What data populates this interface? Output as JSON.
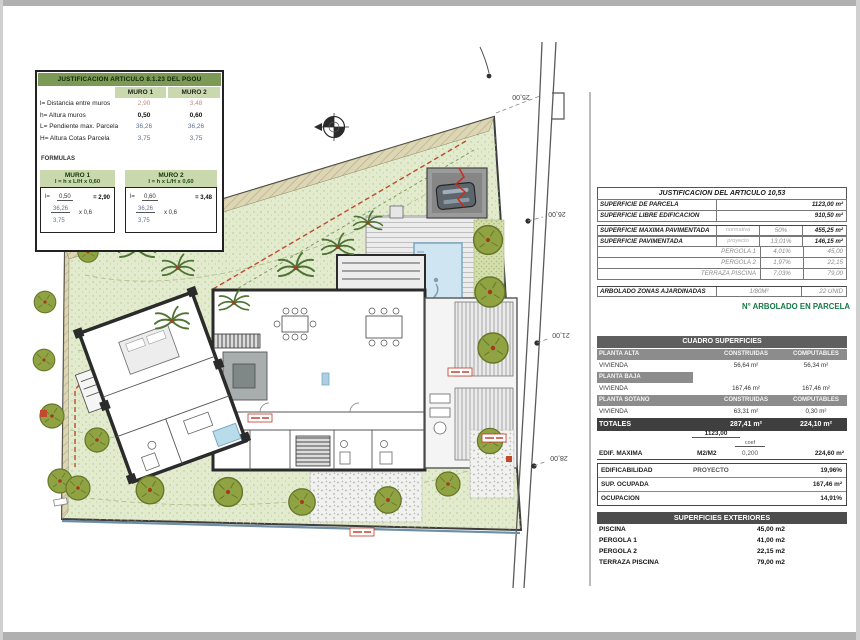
{
  "muros": {
    "title": "JUSTIFICACION ARTICULO 8.1.23 DEL PGOU",
    "col1": "MURO 1",
    "col2": "MURO 2",
    "rows": [
      {
        "label": "l= Distancia entre muros",
        "v1": "2,90",
        "v2": "3,48"
      },
      {
        "label": "h= Altura muros",
        "v1": "0,50",
        "v2": "0,60"
      },
      {
        "label": "L= Pendiente max. Parcela",
        "v1": "36,26",
        "v2": "36,26"
      },
      {
        "label": "H= Altura Cotas Parcela",
        "v1": "3,75",
        "v2": "3,75"
      }
    ],
    "formulas_label": "FORMULAS",
    "boxes": [
      {
        "name": "MURO 1",
        "rule": "l = h x L/H x 0,60",
        "lhs": "l=",
        "num": "0,50",
        "den_top": "36,26",
        "den_bot": "3,75",
        "mult": "x 0,6",
        "result": "= 2,90"
      },
      {
        "name": "MURO 2",
        "rule": "l = h x L/H x 0,60",
        "lhs": "l=",
        "num": "0,60",
        "den_top": "36,26",
        "den_bot": "3,75",
        "mult": "x 0,6",
        "result": "= 3,48"
      }
    ]
  },
  "plan": {
    "dims": [
      "25,00",
      "26,00",
      "21,00",
      "28,00"
    ]
  },
  "justif": {
    "title": "JUSTIFICACION DEL ARTICULO 10,53",
    "rows": [
      {
        "label": "SUPERFICIE DE PARCELA",
        "val": "1123,00 m²"
      },
      {
        "label": "SUPERFICIE LIBRE EDIFICACION",
        "val": "910,50 m²"
      },
      {
        "label": "SUPERFICIE MAXIMA PAVIMENTADA",
        "mid": "normativa",
        "pct": "50%",
        "val": "455,25 m²"
      },
      {
        "label": "SUPERFICIE PAVIMENTADA",
        "mid": "proyecto",
        "pct": "13,01%",
        "val": "146,15 m²"
      },
      {
        "label": "PERGOLA 1",
        "pct": "4,01%",
        "val": "45,00"
      },
      {
        "label": "PERGOLA 2",
        "pct": "1,97%",
        "val": "22,15"
      },
      {
        "label": "TERRAZA PISCINA",
        "pct": "7,03%",
        "val": "79,00"
      },
      {
        "label": "ARBOLADO ZONAS AJARDINADAS",
        "pct": "1/80M²",
        "val": "22 UNID"
      }
    ]
  },
  "arbolado_note": "N° ARBOLADO EN PARCELA",
  "cuadro": {
    "title": "CUADRO SUPERFICIES",
    "col_construidas": "CONSTRUIDAS",
    "col_computables": "COMPUTABLES",
    "banda_alta": "PLANTA ALTA",
    "banda_baja": "PLANTA BAJA",
    "banda_sotano": "PLANTA SOTANO",
    "vivienda": "VIVIENDA",
    "alta": {
      "construidas": "56,64 m²",
      "computables": "56,34 m²"
    },
    "baja": {
      "construidas": "167,46 m²",
      "computables": "167,46 m²"
    },
    "sotano": {
      "construidas": "63,31 m²",
      "computables": "0,30 m²"
    },
    "totales": {
      "label": "TOTALES",
      "construidas": "287,41 m²",
      "computables": "224,10 m²"
    }
  },
  "edif": {
    "parcela": "1123,00",
    "coef_label": "coef",
    "label": "EDIF. MAXIMA",
    "unit": "M2/M2",
    "coef": "0,200",
    "val": "224,60 m²"
  },
  "resumen": {
    "rows": [
      {
        "label": "EDIFICABILIDAD",
        "mid": "PROYECTO",
        "val": "19,96%"
      },
      {
        "label": "SUP. OCUPADA",
        "mid": "",
        "val": "167,46 m²"
      },
      {
        "label": "OCUPACION",
        "mid": "",
        "val": "14,91%"
      }
    ]
  },
  "ext": {
    "title": "SUPERFICIES EXTERIORES",
    "rows": [
      {
        "label": "PISCINA",
        "val": "45,00 m2"
      },
      {
        "label": "PERGOLA 1",
        "val": "41,00 m2"
      },
      {
        "label": "PERGOLA 2",
        "val": "22,15 m2"
      },
      {
        "label": "TERRAZA PISCINA",
        "val": "79,00 m2"
      }
    ]
  },
  "colors": {
    "table_green": "#7a9a55",
    "table_green_light": "#c9d9ad",
    "lawn": "#e2ebcd",
    "pool": "#cfe5f2",
    "red_line": "#bf4a2e",
    "note_green": "#157a45"
  }
}
